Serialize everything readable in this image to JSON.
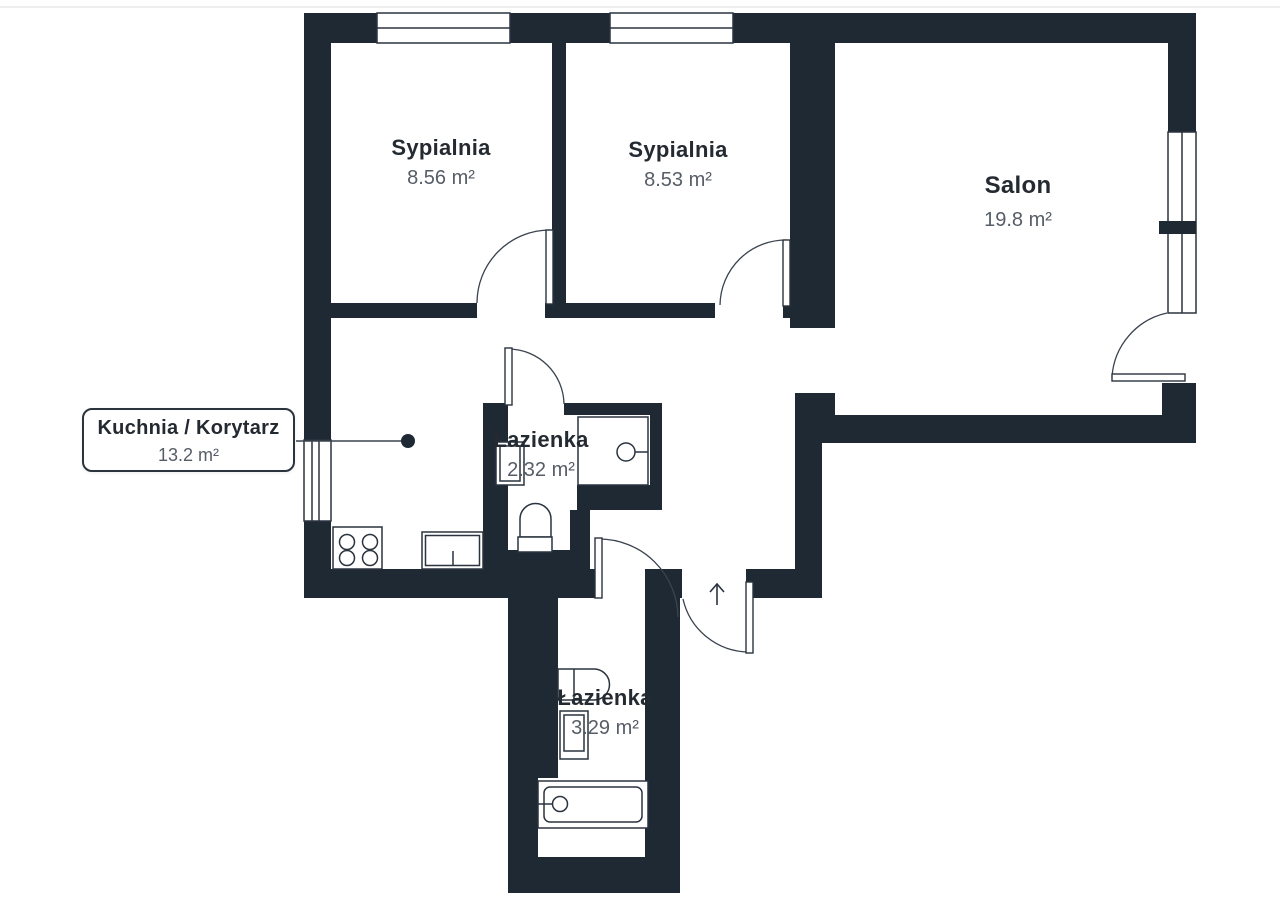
{
  "page": {
    "background": "#ffffff",
    "top_divider_color": "#eceef0"
  },
  "floor_plan": {
    "wall_color": "#1f2933",
    "thin_line_color": "#39424e",
    "room_name_color": "#242a31",
    "room_area_color": "#565d66",
    "rooms": [
      {
        "id": "bedroom-1",
        "name": "Sypialnia",
        "area": "8.56 m²"
      },
      {
        "id": "bedroom-2",
        "name": "Sypialnia",
        "area": "8.53 m²"
      },
      {
        "id": "living-room",
        "name": "Salon",
        "area": "19.8 m²"
      },
      {
        "id": "bathroom-upper",
        "name": "Łazienka",
        "area": "2.32 m²"
      },
      {
        "id": "bathroom-lower",
        "name": "Łazienka",
        "area": "3.29 m²"
      },
      {
        "id": "kitchen-corridor",
        "name": "Kuchnia / Korytarz",
        "area": "13.2 m²"
      }
    ],
    "icons": [
      "window-icon",
      "door-arc-icon",
      "entry-arrow-icon",
      "stove-icon",
      "kitchen-sink-icon",
      "washbasin-icon",
      "shower-icon",
      "toilet-icon",
      "bathtub-icon",
      "leader-dot-icon"
    ]
  }
}
